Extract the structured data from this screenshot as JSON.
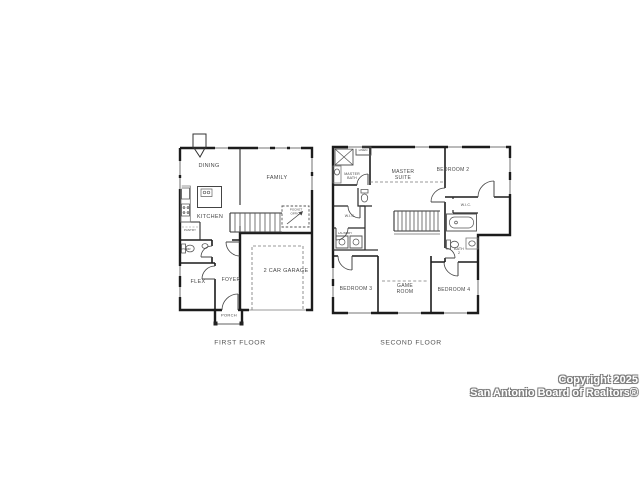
{
  "colors": {
    "background": "#ffffff",
    "wall": "#1c1c1c",
    "window": "#b0b0b0",
    "label_text": "#474747",
    "watermark_fill": "#ffffff",
    "watermark_outline": "#7d7d7d"
  },
  "first_floor": {
    "caption": "FIRST FLOOR",
    "rooms": {
      "dining": "DINING",
      "family": "FAMILY",
      "kitchen": "KITCHEN",
      "pantry": "PANTRY",
      "powder": "PWDR",
      "pocket_office": "POCKET\nOFFICE",
      "flex": "FLEX",
      "foyer": "FOYER",
      "garage": "2 CAR GARAGE",
      "porch": "PORCH"
    }
  },
  "second_floor": {
    "caption": "SECOND FLOOR",
    "rooms": {
      "master_bath": "MASTER\nBATH",
      "linen": "LINEN",
      "master_suite": "MASTER\nSUITE",
      "bedroom_2": "BEDROOM 2",
      "wic_master": "W.I.C.",
      "wic_bedroom_2": "W.I.C.",
      "laundry": "LAUNDRY",
      "bedroom_3": "BEDROOM 3",
      "game_room": "GAME\nROOM",
      "bedroom_4": "BEDROOM 4",
      "bath_2": "BATH\n2"
    }
  },
  "watermark": {
    "line1": "Copyright 2025",
    "line2": "San Antonio Board of Realtors®"
  }
}
